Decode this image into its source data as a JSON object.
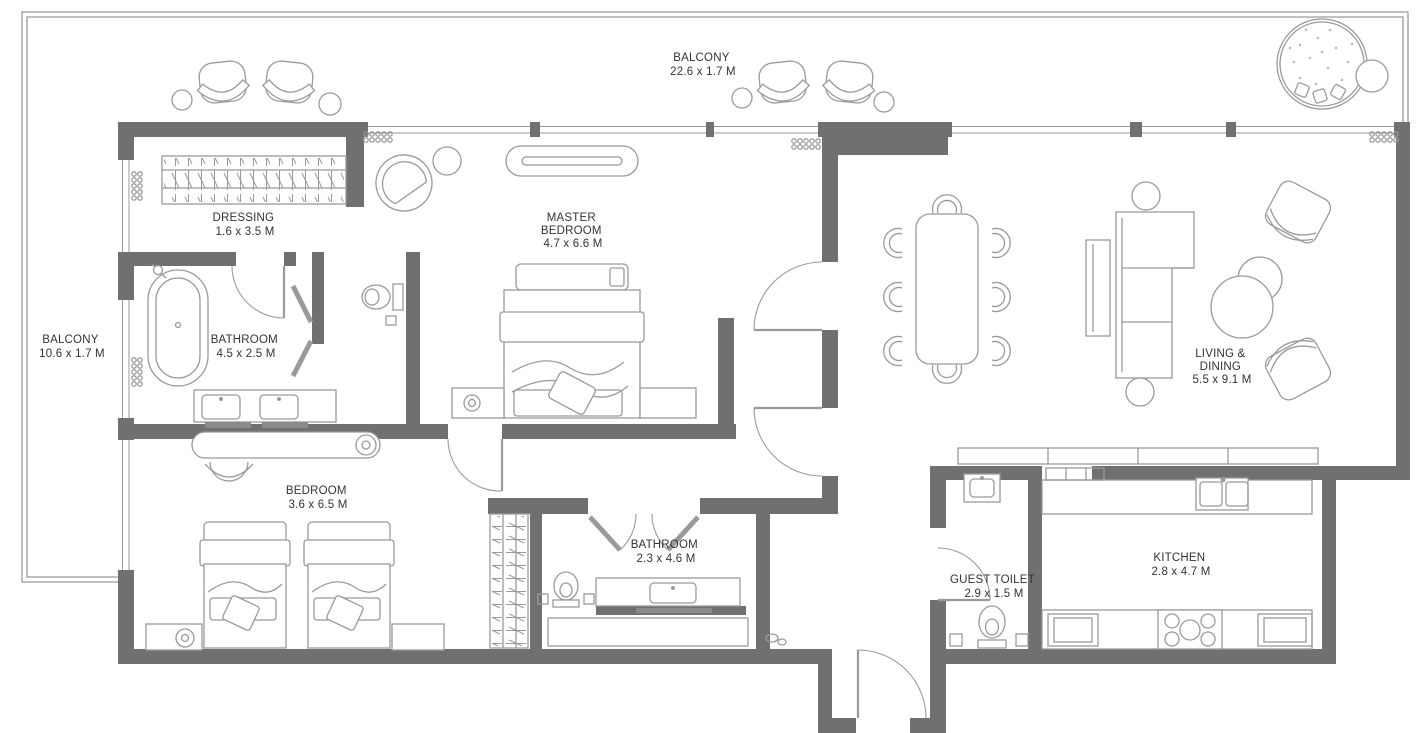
{
  "title": "Apartment floor plan",
  "colors": {
    "background": "#ffffff",
    "wall": "#707070",
    "line": "#9a9a9a",
    "text": "#333333"
  },
  "rooms": {
    "balcony_top": {
      "name": "BALCONY",
      "dims": "22.6 x 1.7 M"
    },
    "balcony_left": {
      "name": "BALCONY",
      "dims": "10.6 x 1.7 M"
    },
    "dressing": {
      "name": "DRESSING",
      "dims": "1.6 x 3.5 M"
    },
    "master_bedroom": {
      "name": "MASTER",
      "name2": "BEDROOM",
      "dims": "4.7 x 6.6 M"
    },
    "master_bathroom": {
      "name": "BATHROOM",
      "dims": "4.5 x 2.5 M"
    },
    "bedroom": {
      "name": "BEDROOM",
      "dims": "3.6 x 6.5 M"
    },
    "bathroom": {
      "name": "BATHROOM",
      "dims": "2.3 x 4.6 M"
    },
    "guest_toilet": {
      "name": "GUEST TOILET",
      "dims": "2.9 x 1.5 M"
    },
    "kitchen": {
      "name": "KITCHEN",
      "dims": "2.8 x 4.7 M"
    },
    "living_dining": {
      "name": "LIVING &",
      "name2": "DINING",
      "dims": "5.5 x 9.1 M"
    }
  },
  "furniture_items": [
    "balcony-armchairs",
    "balcony-side-tables",
    "planter",
    "wardrobe-hangers",
    "master-bed",
    "nightstands",
    "tv-console",
    "armchair",
    "bathtub",
    "double-vanity",
    "toilet",
    "shower-doors",
    "twin-beds",
    "desk",
    "desk-chair",
    "dining-table-8-chairs",
    "l-shaped-sofa",
    "coffee-tables",
    "lounge-chairs",
    "kitchen-sink",
    "cooktop",
    "kitchen-cabinets",
    "guest-wc",
    "guest-basin",
    "sideboard"
  ]
}
